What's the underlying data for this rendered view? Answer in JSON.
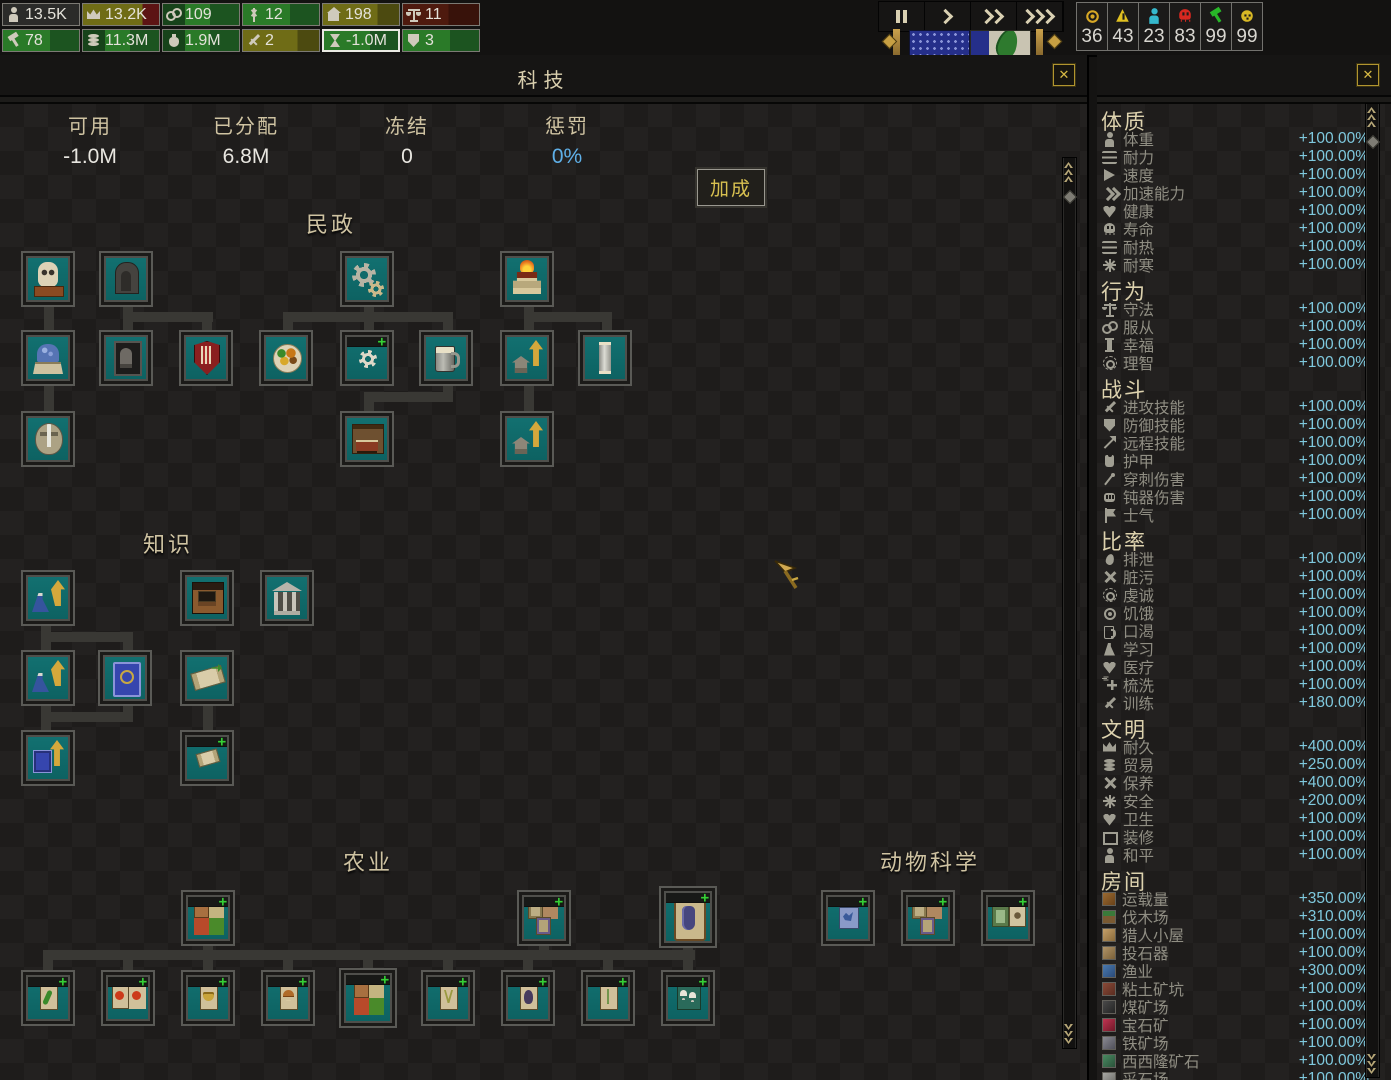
{
  "topbar": {
    "resources_row1": [
      {
        "icon": "person",
        "value": "13.5K",
        "tone": "dark"
      },
      {
        "icon": "crown",
        "value": "13.2K",
        "tone": "olivered"
      },
      {
        "icon": "chain",
        "value": "109",
        "tone": "green"
      },
      {
        "icon": "wheat",
        "value": "12",
        "tone": "green2"
      },
      {
        "icon": "house",
        "value": "198",
        "tone": "olive"
      },
      {
        "icon": "scales",
        "value": "11",
        "tone": "maroon"
      }
    ],
    "resources_row2": [
      {
        "icon": "hammer",
        "value": "78",
        "tone": "green2"
      },
      {
        "icon": "coins",
        "value": "11.3M",
        "tone": "green"
      },
      {
        "icon": "pouch",
        "value": "1.9M",
        "tone": "green"
      },
      {
        "icon": "sword",
        "value": "2",
        "tone": "olive"
      },
      {
        "icon": "hourglass",
        "value": "-1.0M",
        "tone": "green2",
        "selected": true
      },
      {
        "icon": "shield-heart",
        "value": "3",
        "tone": "green2"
      }
    ],
    "speed_controls": [
      {
        "icon": "pause-icon",
        "type": "pause"
      },
      {
        "icon": "play-icon",
        "type": "chev",
        "count": 1
      },
      {
        "icon": "fast-icon",
        "type": "chev",
        "count": 2
      },
      {
        "icon": "fastest-icon",
        "type": "chev",
        "count": 3
      }
    ],
    "alerts": [
      {
        "icon": "coin-medal",
        "value": "36",
        "color": "#d8a825",
        "shape": "coin"
      },
      {
        "icon": "warning",
        "value": "43",
        "color": "#e0c020",
        "shape": "tribang"
      },
      {
        "icon": "citizen",
        "value": "23",
        "color": "#35b8cc",
        "shape": "person"
      },
      {
        "icon": "death-skull",
        "value": "83",
        "color": "#d82820",
        "shape": "skull"
      },
      {
        "icon": "tool",
        "value": "99",
        "color": "#28b828",
        "shape": "hammer"
      },
      {
        "icon": "happiness",
        "value": "99",
        "color": "#d8b825",
        "shape": "face"
      }
    ]
  },
  "panel": {
    "title": "科技",
    "close_label": "✕",
    "stats": [
      {
        "label": "可用",
        "value": "-1.0M",
        "blue": false
      },
      {
        "label": "已分配",
        "value": "6.8M",
        "blue": false
      },
      {
        "label": "冻结",
        "value": "0",
        "blue": false
      },
      {
        "label": "惩罚",
        "value": "0%",
        "blue": true
      }
    ],
    "bonus_button": "加成",
    "accent_blue": "#5fb0e8",
    "teal_node": "#0f6a6a"
  },
  "tree": {
    "sections": [
      {
        "title": "民政",
        "cx": 331,
        "y": 207
      },
      {
        "title": "知识",
        "cx": 168,
        "y": 527
      },
      {
        "title": "农业",
        "cx": 368,
        "y": 845
      },
      {
        "title": "动物科学",
        "cx": 930,
        "y": 845
      }
    ],
    "nodes": [
      {
        "x": 21,
        "y": 251,
        "icon": "mask",
        "name": "masks"
      },
      {
        "x": 99,
        "y": 251,
        "icon": "throne",
        "name": "throne"
      },
      {
        "x": 340,
        "y": 251,
        "icon": "gears",
        "name": "machinery"
      },
      {
        "x": 500,
        "y": 251,
        "icon": "altar",
        "name": "altar"
      },
      {
        "x": 21,
        "y": 330,
        "icon": "fountain",
        "name": "fountain"
      },
      {
        "x": 99,
        "y": 330,
        "icon": "grave",
        "name": "tomb"
      },
      {
        "x": 179,
        "y": 330,
        "icon": "redshield",
        "name": "red-banner"
      },
      {
        "x": 259,
        "y": 330,
        "icon": "food",
        "name": "cuisine"
      },
      {
        "x": 340,
        "y": 330,
        "icon": "gearsm",
        "name": "workshop",
        "plus": true
      },
      {
        "x": 419,
        "y": 330,
        "icon": "mug",
        "name": "brewing"
      },
      {
        "x": 500,
        "y": 330,
        "icon": "upgrade",
        "name": "home-upgrade-1"
      },
      {
        "x": 578,
        "y": 330,
        "icon": "pillar",
        "name": "pillar"
      },
      {
        "x": 21,
        "y": 411,
        "icon": "swordshield",
        "name": "guard"
      },
      {
        "x": 340,
        "y": 411,
        "icon": "bed",
        "name": "furniture"
      },
      {
        "x": 500,
        "y": 411,
        "icon": "upgrade",
        "name": "home-upgrade-2"
      },
      {
        "x": 21,
        "y": 570,
        "icon": "flaskup",
        "name": "research-boost-1"
      },
      {
        "x": 180,
        "y": 570,
        "icon": "school",
        "name": "school"
      },
      {
        "x": 260,
        "y": 570,
        "icon": "library",
        "name": "library"
      },
      {
        "x": 21,
        "y": 650,
        "icon": "flaskup",
        "name": "research-boost-2"
      },
      {
        "x": 98,
        "y": 650,
        "icon": "bluebook",
        "name": "tome"
      },
      {
        "x": 180,
        "y": 650,
        "icon": "scroll",
        "name": "scroll"
      },
      {
        "x": 21,
        "y": 730,
        "icon": "bookup",
        "name": "book-upgrade"
      },
      {
        "x": 180,
        "y": 730,
        "icon": "scrollsm",
        "name": "scroll-unlock",
        "plus": true
      },
      {
        "x": 181,
        "y": 890,
        "icon": "grid4",
        "name": "crops-pack",
        "plus": true
      },
      {
        "x": 517,
        "y": 890,
        "icon": "cards3",
        "name": "herb-pack",
        "plus": true
      },
      {
        "x": 659,
        "y": 886,
        "w": 58,
        "h": 62,
        "icon": "potcard",
        "name": "big-crop",
        "plus": true
      },
      {
        "x": 21,
        "y": 970,
        "icon": "cardgreen",
        "name": "crop-cucumber",
        "plus": true
      },
      {
        "x": 101,
        "y": 970,
        "icon": "cardtomato",
        "name": "crop-fruit",
        "plus": true
      },
      {
        "x": 181,
        "y": 970,
        "icon": "cardbasket",
        "name": "crop-grain",
        "plus": true
      },
      {
        "x": 261,
        "y": 970,
        "icon": "cardmushroom",
        "name": "crop-mushroom",
        "plus": true
      },
      {
        "x": 339,
        "y": 968,
        "w": 58,
        "h": 60,
        "icon": "grid4",
        "name": "crop-mix",
        "plus": true
      },
      {
        "x": 421,
        "y": 970,
        "icon": "cardherb",
        "name": "crop-herb",
        "plus": true
      },
      {
        "x": 501,
        "y": 970,
        "icon": "cardbird",
        "name": "crop-aubergine",
        "plus": true
      },
      {
        "x": 581,
        "y": 970,
        "icon": "cardsprig",
        "name": "crop-sprig",
        "plus": true
      },
      {
        "x": 661,
        "y": 970,
        "icon": "cardshrooms",
        "name": "crop-fungi",
        "plus": true
      },
      {
        "x": 821,
        "y": 890,
        "icon": "cardblue",
        "name": "animal-blue",
        "plus": true
      },
      {
        "x": 901,
        "y": 890,
        "icon": "cards3",
        "name": "animal-pack",
        "plus": true
      },
      {
        "x": 981,
        "y": 890,
        "icon": "cards2",
        "name": "animal-scrolls",
        "plus": true
      }
    ],
    "connectors": [
      {
        "x": 44,
        "y": 306,
        "w": 10,
        "h": 24
      },
      {
        "x": 123,
        "y": 306,
        "w": 10,
        "h": 24
      },
      {
        "x": 123,
        "y": 312,
        "w": 90,
        "h": 10
      },
      {
        "x": 202,
        "y": 316,
        "w": 10,
        "h": 14
      },
      {
        "x": 364,
        "y": 306,
        "w": 10,
        "h": 24
      },
      {
        "x": 283,
        "y": 312,
        "w": 170,
        "h": 10
      },
      {
        "x": 283,
        "y": 316,
        "w": 10,
        "h": 14
      },
      {
        "x": 443,
        "y": 316,
        "w": 10,
        "h": 14
      },
      {
        "x": 524,
        "y": 306,
        "w": 10,
        "h": 24
      },
      {
        "x": 524,
        "y": 312,
        "w": 88,
        "h": 10
      },
      {
        "x": 602,
        "y": 316,
        "w": 10,
        "h": 14
      },
      {
        "x": 44,
        "y": 386,
        "w": 10,
        "h": 25
      },
      {
        "x": 443,
        "y": 386,
        "w": 10,
        "h": 16
      },
      {
        "x": 364,
        "y": 392,
        "w": 89,
        "h": 10
      },
      {
        "x": 364,
        "y": 398,
        "w": 10,
        "h": 13
      },
      {
        "x": 524,
        "y": 386,
        "w": 10,
        "h": 25
      },
      {
        "x": 41,
        "y": 625,
        "w": 10,
        "h": 26
      },
      {
        "x": 41,
        "y": 632,
        "w": 92,
        "h": 10
      },
      {
        "x": 123,
        "y": 640,
        "w": 10,
        "h": 11
      },
      {
        "x": 41,
        "y": 705,
        "w": 10,
        "h": 26
      },
      {
        "x": 41,
        "y": 712,
        "w": 92,
        "h": 10
      },
      {
        "x": 123,
        "y": 705,
        "w": 10,
        "h": 15
      },
      {
        "x": 203,
        "y": 705,
        "w": 10,
        "h": 26
      },
      {
        "x": 43,
        "y": 950,
        "w": 652,
        "h": 10
      },
      {
        "x": 43,
        "y": 956,
        "w": 10,
        "h": 14
      },
      {
        "x": 123,
        "y": 956,
        "w": 10,
        "h": 14
      },
      {
        "x": 203,
        "y": 956,
        "w": 10,
        "h": 14
      },
      {
        "x": 283,
        "y": 956,
        "w": 10,
        "h": 14
      },
      {
        "x": 363,
        "y": 956,
        "w": 10,
        "h": 14
      },
      {
        "x": 443,
        "y": 956,
        "w": 10,
        "h": 14
      },
      {
        "x": 523,
        "y": 956,
        "w": 10,
        "h": 14
      },
      {
        "x": 603,
        "y": 956,
        "w": 10,
        "h": 14
      },
      {
        "x": 683,
        "y": 956,
        "w": 10,
        "h": 14
      },
      {
        "x": 203,
        "y": 944,
        "w": 10,
        "h": 8
      },
      {
        "x": 539,
        "y": 944,
        "w": 10,
        "h": 8
      },
      {
        "x": 683,
        "y": 946,
        "w": 10,
        "h": 6
      }
    ]
  },
  "sidebar": {
    "close_label": "✕",
    "sections": [
      {
        "title": "体质",
        "items": [
          {
            "icon": "person",
            "label": "体重",
            "value": "+100.00%"
          },
          {
            "icon": "waves",
            "label": "耐力",
            "value": "+100.00%"
          },
          {
            "icon": "tri",
            "label": "速度",
            "value": "+100.00%"
          },
          {
            "icon": "chev2",
            "label": "加速能力",
            "value": "+100.00%"
          },
          {
            "icon": "heart",
            "label": "健康",
            "value": "+100.00%"
          },
          {
            "icon": "skull",
            "label": "寿命",
            "value": "+100.00%"
          },
          {
            "icon": "waves",
            "label": "耐热",
            "value": "+100.00%"
          },
          {
            "icon": "aster",
            "label": "耐寒",
            "value": "+100.00%"
          }
        ]
      },
      {
        "title": "行为",
        "items": [
          {
            "icon": "scale",
            "label": "守法",
            "value": "+100.00%"
          },
          {
            "icon": "rings",
            "label": "服从",
            "value": "+100.00%"
          },
          {
            "icon": "pillar",
            "label": "幸福",
            "value": "+100.00%"
          },
          {
            "icon": "sun",
            "label": "理智",
            "value": "+100.00%"
          }
        ]
      },
      {
        "title": "战斗",
        "items": [
          {
            "icon": "sword",
            "label": "进攻技能",
            "value": "+100.00%"
          },
          {
            "icon": "shield",
            "label": "防御技能",
            "value": "+100.00%"
          },
          {
            "icon": "arrow",
            "label": "远程技能",
            "value": "+100.00%"
          },
          {
            "icon": "armor",
            "label": "护甲",
            "value": "+100.00%"
          },
          {
            "icon": "needle",
            "label": "穿刺伤害",
            "value": "+100.00%"
          },
          {
            "icon": "fist",
            "label": "钝器伤害",
            "value": "+100.00%"
          },
          {
            "icon": "flag",
            "label": "士气",
            "value": "+100.00%"
          }
        ]
      },
      {
        "title": "比率",
        "items": [
          {
            "icon": "drop",
            "label": "排泄",
            "value": "+100.00%"
          },
          {
            "icon": "x",
            "label": "脏污",
            "value": "+100.00%"
          },
          {
            "icon": "sun",
            "label": "虔诚",
            "value": "+100.00%"
          },
          {
            "icon": "coin",
            "label": "饥饿",
            "value": "+100.00%"
          },
          {
            "icon": "mug",
            "label": "口渴",
            "value": "+100.00%"
          },
          {
            "icon": "flask",
            "label": "学习",
            "value": "+100.00%"
          },
          {
            "icon": "heart",
            "label": "医疗",
            "value": "+100.00%"
          },
          {
            "icon": "plus",
            "label": "梳洗",
            "value": "+100.00%"
          },
          {
            "icon": "sword",
            "label": "训练",
            "value": "+180.00%"
          }
        ]
      },
      {
        "title": "文明",
        "items": [
          {
            "icon": "crown",
            "label": "耐久",
            "value": "+400.00%"
          },
          {
            "icon": "coins",
            "label": "贸易",
            "value": "+250.00%"
          },
          {
            "icon": "x",
            "label": "保养",
            "value": "+400.00%"
          },
          {
            "icon": "aster",
            "label": "安全",
            "value": "+200.00%"
          },
          {
            "icon": "heart",
            "label": "卫生",
            "value": "+100.00%"
          },
          {
            "icon": "frame",
            "label": "装修",
            "value": "+100.00%"
          },
          {
            "icon": "person",
            "label": "和平",
            "value": "+100.00%"
          }
        ]
      },
      {
        "title": "房间",
        "items": [
          {
            "icon": "room",
            "room": "crate",
            "label": "运载量",
            "value": "+350.00%"
          },
          {
            "icon": "room",
            "room": "wood",
            "label": "伐木场",
            "value": "+310.00%"
          },
          {
            "icon": "room",
            "room": "hunter",
            "label": "猎人小屋",
            "value": "+100.00%"
          },
          {
            "icon": "room",
            "room": "catapult",
            "label": "投石器",
            "value": "+100.00%"
          },
          {
            "icon": "room",
            "room": "fish",
            "label": "渔业",
            "value": "+300.00%"
          },
          {
            "icon": "room",
            "room": "clay",
            "label": "粘土矿坑",
            "value": "+100.00%"
          },
          {
            "icon": "room",
            "room": "coal",
            "label": "煤矿场",
            "value": "+100.00%"
          },
          {
            "icon": "room",
            "room": "gem",
            "label": "宝石矿",
            "value": "+100.00%"
          },
          {
            "icon": "room",
            "room": "iron",
            "label": "铁矿场",
            "value": "+100.00%"
          },
          {
            "icon": "room",
            "room": "sisilon",
            "label": "西西隆矿石",
            "value": "+100.00%"
          },
          {
            "icon": "room",
            "room": "quarry",
            "label": "采石场",
            "value": "+100.00%"
          }
        ]
      }
    ],
    "value_color": "#7fc9de"
  },
  "cursor": {
    "x": 772,
    "y": 558
  }
}
